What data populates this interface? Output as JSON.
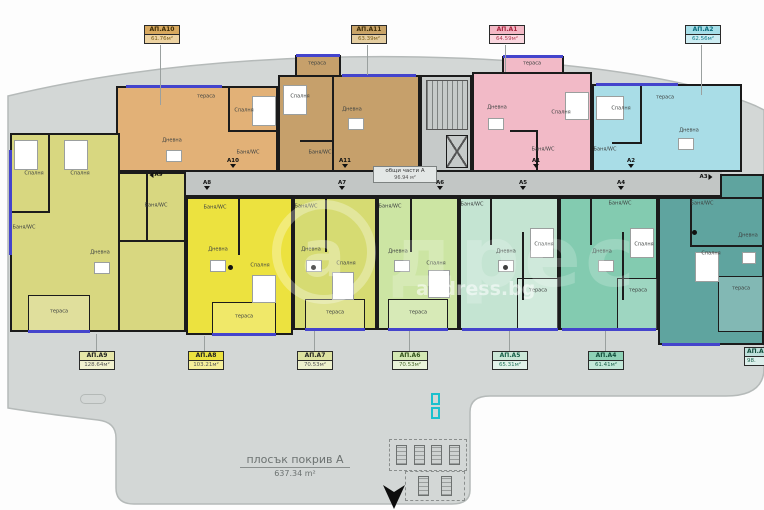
{
  "apartments": [
    {
      "id": "a10",
      "label": "АП.А10",
      "area": "61.76м²",
      "rooms": [
        "тераса",
        "Спалня",
        "Дневна",
        "Баня/WC"
      ]
    },
    {
      "id": "a11",
      "label": "АП.А11",
      "area": "63.39м²",
      "rooms": [
        "тераса",
        "Спалня",
        "Дневна",
        "Баня/WC"
      ]
    },
    {
      "id": "a1",
      "label": "АП.А1",
      "area": "64.59м²",
      "rooms": [
        "тераса",
        "Дневна",
        "Спалня",
        "Баня/WC"
      ]
    },
    {
      "id": "a2",
      "label": "АП.А2",
      "area": "62.56м²",
      "rooms": [
        "тераса",
        "Спалня",
        "Дневна",
        "Баня/WC"
      ]
    },
    {
      "id": "a9",
      "label": "АП.А9",
      "area": "128.64м²",
      "rooms": [
        "Спалня",
        "Спалня",
        "Баня/WC",
        "Баня/WC",
        "Дневна",
        "тераса"
      ]
    },
    {
      "id": "a8",
      "label": "АП.А8",
      "area": "103.21м²",
      "rooms": [
        "Баня/WC",
        "Дневна",
        "Спалня",
        "тераса"
      ]
    },
    {
      "id": "a7",
      "label": "АП.А7",
      "area": "70.53м²",
      "rooms": [
        "Баня/WC",
        "Дневна",
        "Спалня",
        "тераса"
      ]
    },
    {
      "id": "a6",
      "label": "АП.А6",
      "area": "70.53м²",
      "rooms": [
        "Баня/WC",
        "Дневна",
        "Спалня",
        "тераса"
      ]
    },
    {
      "id": "a5",
      "label": "АП.А5",
      "area": "65.31м²",
      "rooms": [
        "Баня/WC",
        "Дневна",
        "Спалня",
        "тераса"
      ]
    },
    {
      "id": "a4",
      "label": "АП.А4",
      "area": "61.41м²",
      "rooms": [
        "Баня/WC",
        "Дневна",
        "Спалня",
        "тераса"
      ]
    },
    {
      "id": "a3",
      "label": "АП.А3",
      "area": "98.",
      "rooms": [
        "Баня/WC",
        "Спалня",
        "Дневна",
        "тераса"
      ]
    }
  ],
  "common_area": {
    "label": "общи части А",
    "area": "96.94 м²"
  },
  "roof": {
    "label": "плосък покрив А",
    "area": "637.34 m²"
  },
  "axis_markers": [
    "А9",
    "А10",
    "А8",
    "А11",
    "А7",
    "А1",
    "А6",
    "А5",
    "А2",
    "А4",
    "А3"
  ],
  "watermark": {
    "letter": "a",
    "brand": "дрес",
    "site": "address.bg"
  }
}
